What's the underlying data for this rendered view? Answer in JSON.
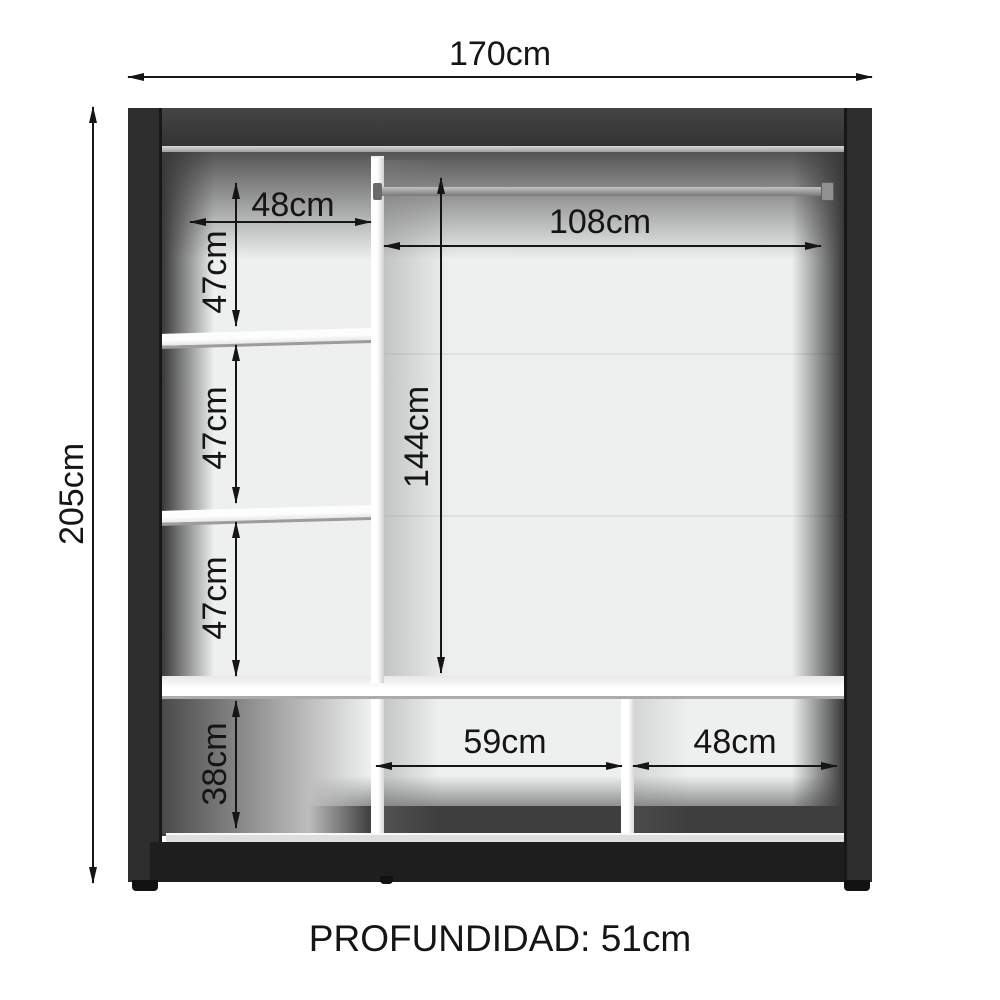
{
  "diagram": {
    "type": "furniture-dimension-drawing",
    "subject": "wardrobe interior front view",
    "footer": {
      "depth_label": "PROFUNDIDAD: 51cm"
    },
    "dimensions": {
      "total_width": "170cm",
      "total_height": "205cm",
      "left_column_width": "48cm",
      "left_gap_1_height": "47cm",
      "left_gap_2_height": "47cm",
      "left_gap_3_height": "47cm",
      "left_bottom_height": "38cm",
      "rod_width": "108cm",
      "hanging_height": "144cm",
      "bottom_middle_width": "59cm",
      "bottom_right_width": "48cm"
    },
    "colors": {
      "frame": "#2d2d2d",
      "frame_top": "#3d3d3d",
      "interior_back": "#eef0f0",
      "shelf_white": "#ffffff",
      "rod_gray": "#9a9a9a",
      "dimension_ink": "#151515",
      "background": "#ffffff"
    }
  }
}
